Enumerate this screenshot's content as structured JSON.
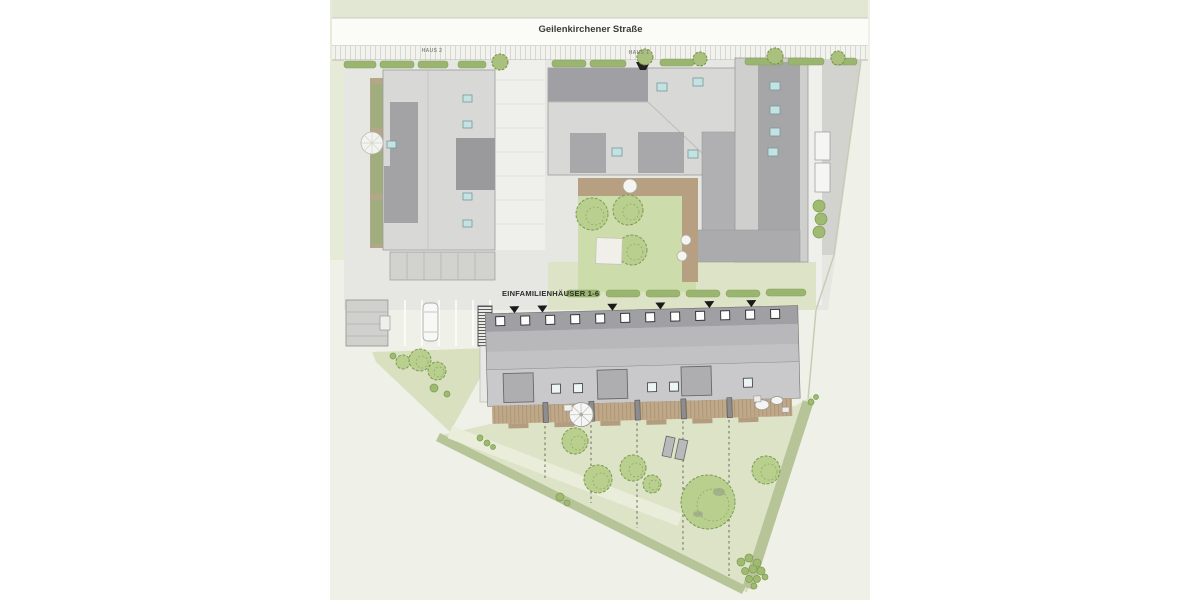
{
  "page": {
    "background_color": "#ffffff"
  },
  "site_plan": {
    "street": {
      "name": "Geilenkirchener Straße"
    },
    "buildings": [
      {
        "id": "haus-2",
        "label": "HAUS 2"
      },
      {
        "id": "haus-1",
        "label": "HAUS 1"
      },
      {
        "id": "einfamilienhaeuser",
        "label": "EINFAMILIENHÄUSER 1-6",
        "units": 6
      }
    ],
    "features": {
      "row_house_skylights": 12,
      "entrance_markers": 6,
      "garden_plots": 6,
      "parked_cars": 1
    },
    "colors": {
      "plan_background": "#eff0e8",
      "street_band": "#fbfbf8",
      "paving": "#e6e6e3",
      "building_light": "#d8d8d6",
      "building_dark": "#a0a0a4",
      "lawn": "#dce3c6",
      "courtyard_lawn": "#cddcab",
      "tree_green": "#b9cf8e",
      "hedge_green": "#9ab56f",
      "deck_wood": "#bfa888",
      "skylight_blue": "#c4e2e2"
    }
  }
}
